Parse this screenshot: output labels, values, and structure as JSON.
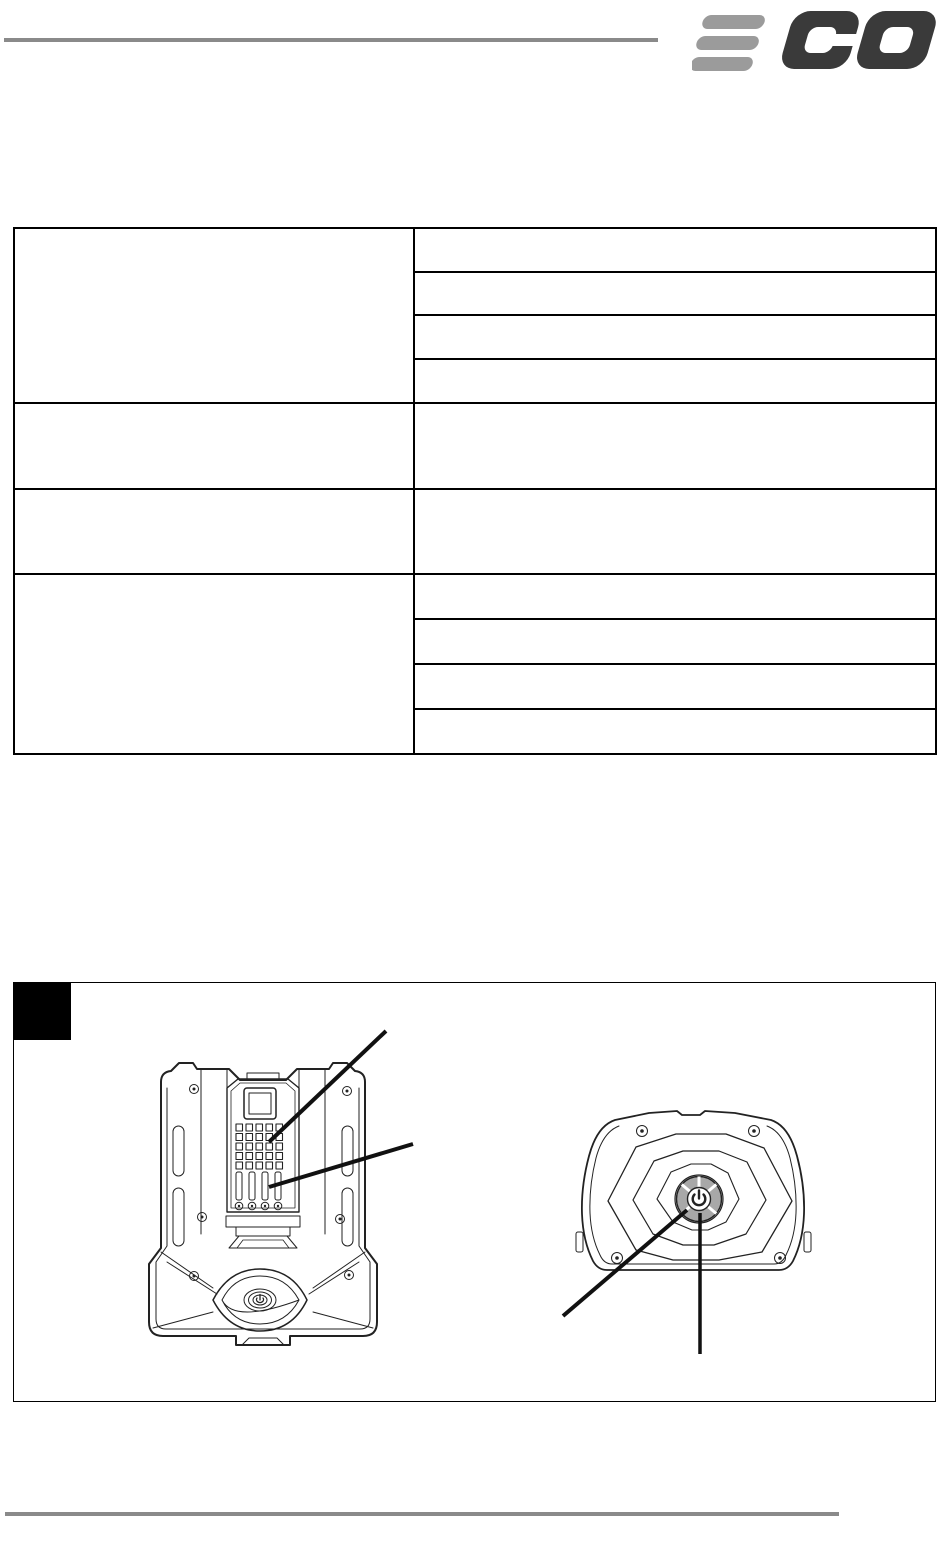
{
  "page": {
    "background": "#ffffff"
  },
  "header": {
    "brand_name": "EGO",
    "rule_color": "#8a8a8a",
    "logo": {
      "bar_color": "#9b9b9b",
      "letter_color": "#3a3a3a"
    }
  },
  "spec_table": {
    "border_color": "#000000",
    "columns": 2,
    "groups": [
      {
        "left": "",
        "right": [
          "",
          "",
          "",
          ""
        ]
      },
      {
        "left": "",
        "right": [
          ""
        ]
      },
      {
        "left": "",
        "right": [
          ""
        ]
      },
      {
        "left": "",
        "right": [
          "",
          "",
          "",
          ""
        ]
      }
    ]
  },
  "figure": {
    "marker_color": "#000000",
    "border_color": "#000000",
    "line_color": "#222222",
    "callout_color": "#111111",
    "illustrations": [
      {
        "name": "battery-pack-front-view",
        "callout_count": 2
      },
      {
        "name": "battery-pack-top-view",
        "callout_count": 2
      }
    ],
    "power_button": {
      "ring_color": "#a8a8a8",
      "symbol": "power"
    }
  },
  "footer": {
    "rule_color": "#8a8a8a"
  }
}
